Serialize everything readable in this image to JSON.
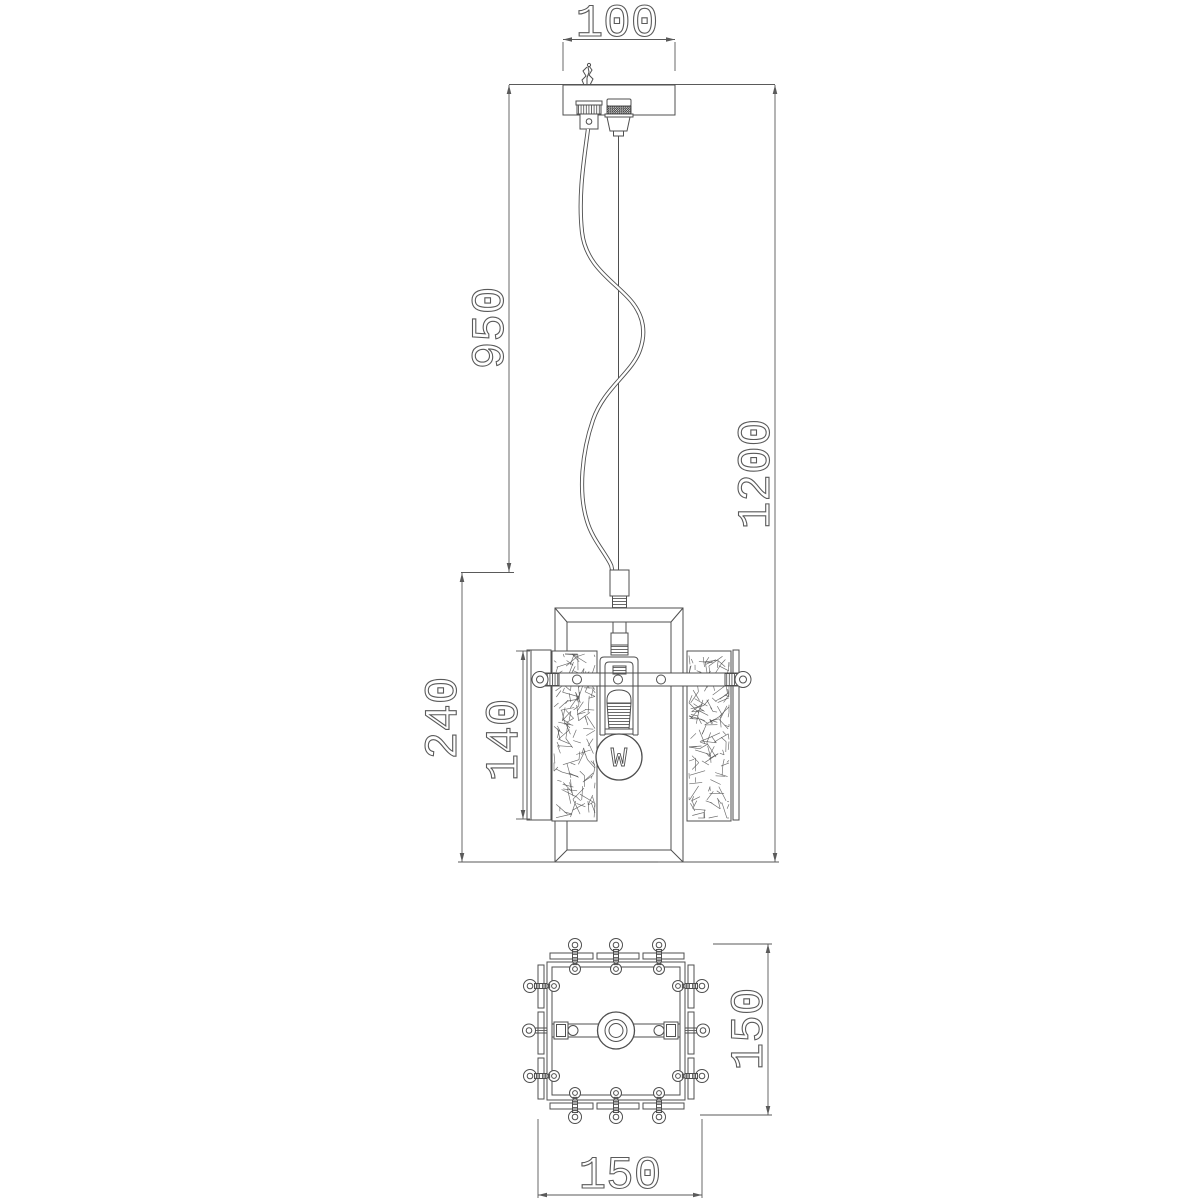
{
  "meta": {
    "background": "#ffffff",
    "line_color": "#4f4f4f",
    "dimension_color": "#5a5a5a",
    "description": "Technical dimensional drawing of a pendant ceiling lamp: front elevation with suspension and caged shade, plus bottom view"
  },
  "front_view": {
    "labels": {
      "canopy_width": "100",
      "suspension_length": "950",
      "overall_height": "1200",
      "body_height": "240",
      "glass_panel_height": "140"
    },
    "bulb_label": "W"
  },
  "bottom_view": {
    "labels": {
      "base_depth": "150",
      "base_width": "150"
    }
  }
}
